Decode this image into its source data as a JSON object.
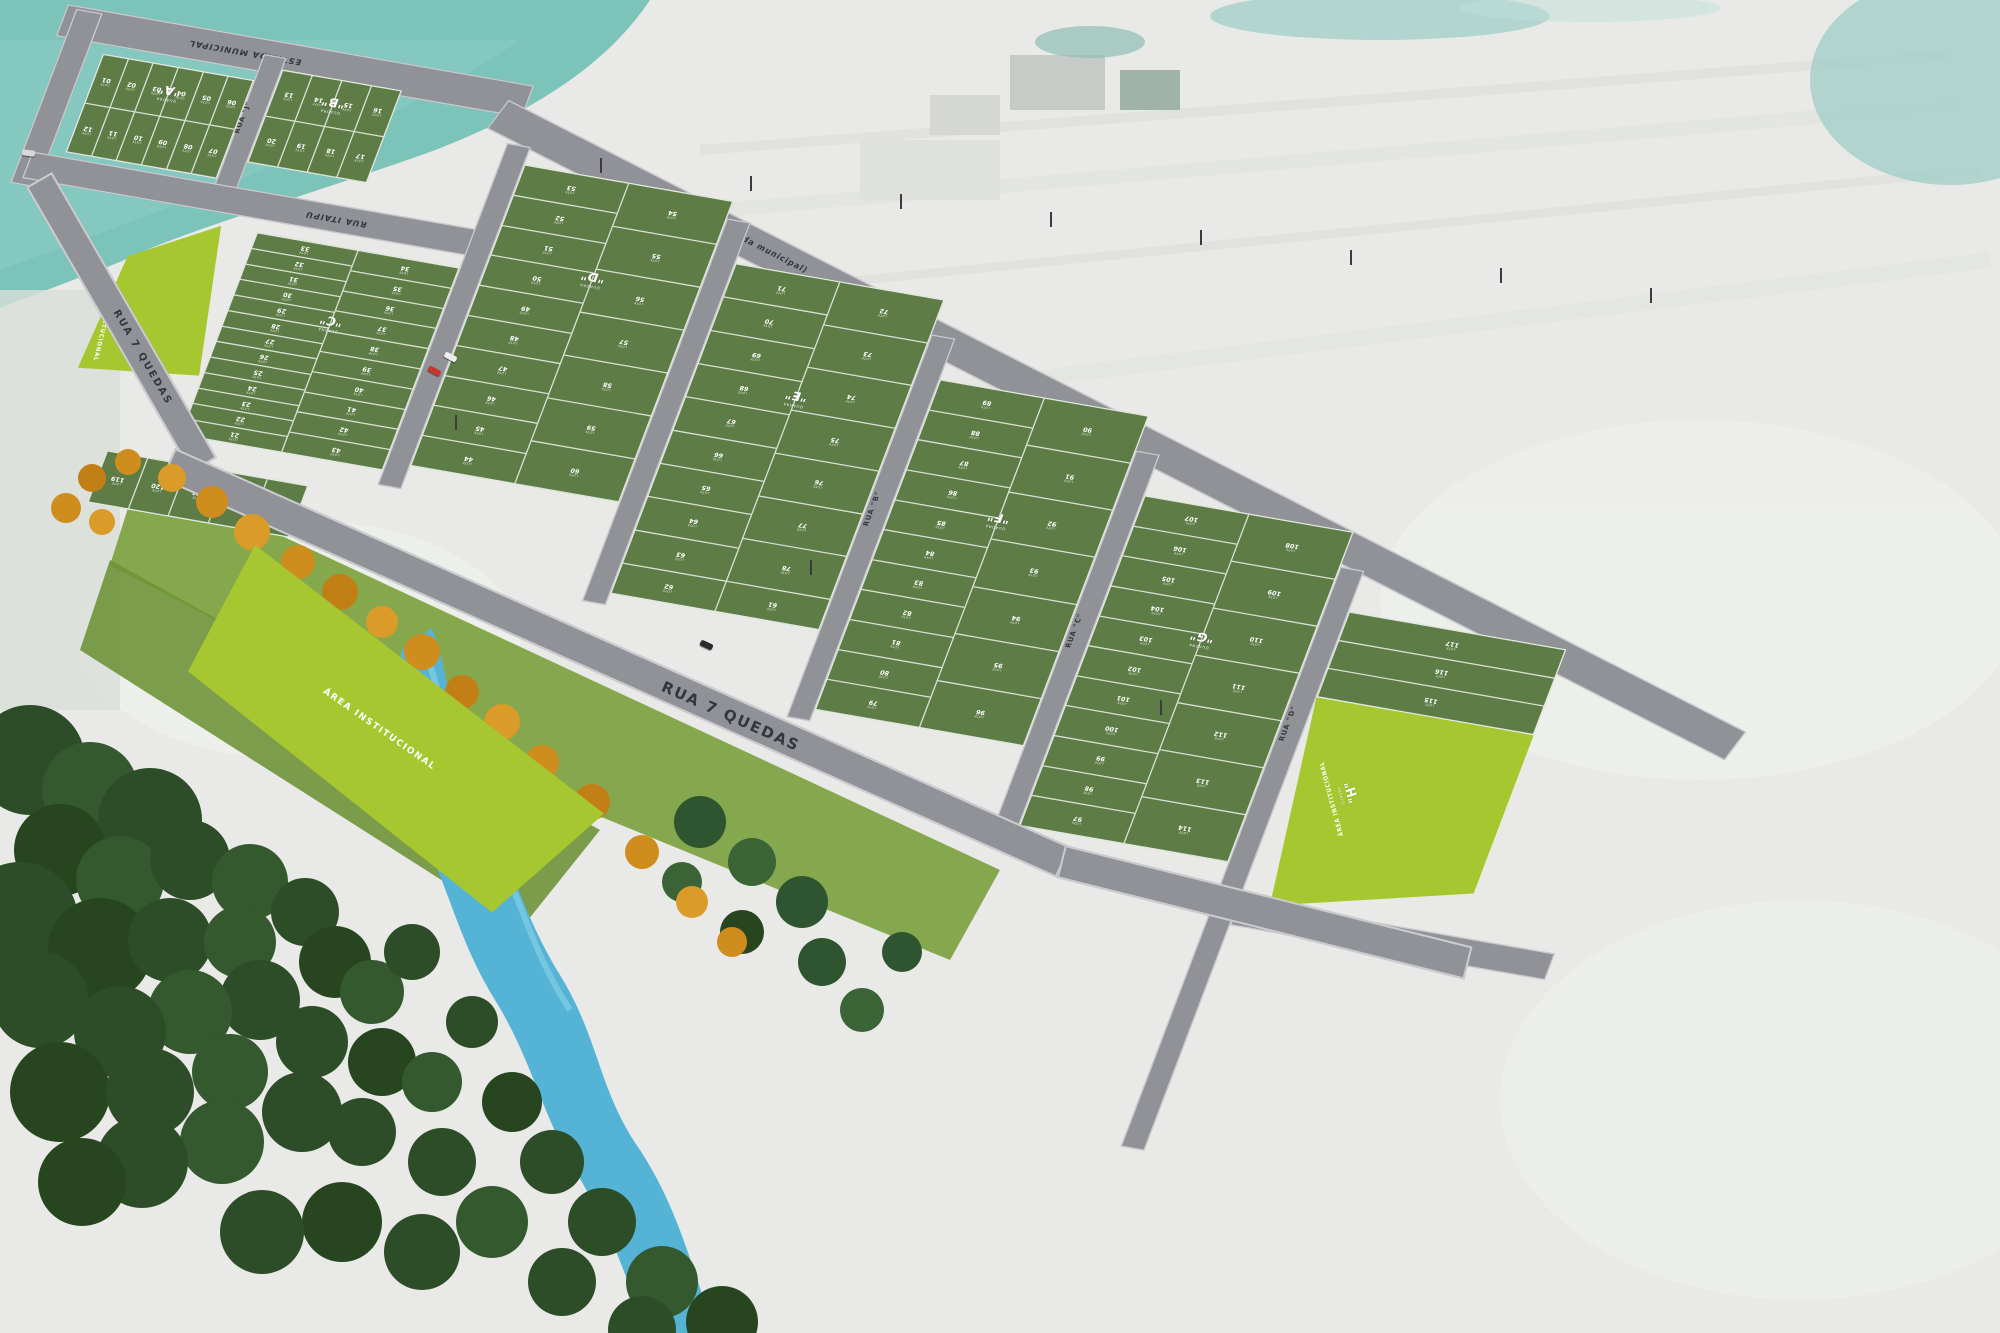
{
  "scene": {
    "quadra_word": "QUADRA",
    "lote_label": "LOTE",
    "streets": {
      "estrada_top": "ESTRADA MUNICIPAL",
      "rua_i": "RUA \"I\" (estrada municipal)",
      "rua_j": "RUA \"J\"",
      "rua_itaipu": "RUA ITAIPU",
      "rua_b": "RUA \"B\"",
      "rua_c": "RUA \"C\"",
      "rua_d": "RUA \"D\"",
      "rua_7quedas_upper": "RUA 7 QUEDAS",
      "rua_7quedas_lower": "RUA 7 QUEDAS"
    },
    "institutional": {
      "left": "ÁREA INSTITUCIONAL",
      "center": "ÁREA INSTITUCIONAL",
      "h": "ÁREA INSTITUCIONAL"
    },
    "blocks": [
      {
        "id": "quadra-a",
        "letter": "\"A\"",
        "type": "rows",
        "rows": [
          [
            "01",
            "02",
            "03",
            "04",
            "05",
            "06"
          ],
          [
            "12",
            "11",
            "10",
            "09",
            "08",
            "07"
          ]
        ]
      },
      {
        "id": "quadra-b",
        "letter": "\"B\"",
        "type": "rows",
        "rows": [
          [
            "13",
            "14",
            "15",
            "16"
          ],
          [
            "20",
            "19",
            "18",
            "17"
          ]
        ]
      },
      {
        "id": "quadra-c",
        "letter": "\"C\"",
        "type": "cols",
        "west": [
          "33",
          "32",
          "31",
          "30",
          "29",
          "28",
          "27",
          "26",
          "25",
          "24",
          "23",
          "22",
          "21"
        ],
        "east": [
          "34",
          "35",
          "36",
          "37",
          "38",
          "39",
          "40",
          "41",
          "42",
          "43"
        ]
      },
      {
        "id": "quadra-d",
        "letter": "\"D\"",
        "type": "cols",
        "west": [
          "53",
          "52",
          "51",
          "50",
          "49",
          "48",
          "47",
          "46",
          "45",
          "44"
        ],
        "east": [
          "54",
          "55",
          "56",
          "57",
          "58",
          "59",
          "60"
        ]
      },
      {
        "id": "quadra-e",
        "letter": "\"E\"",
        "type": "cols",
        "west": [
          "71",
          "70",
          "69",
          "68",
          "67",
          "66",
          "65",
          "64",
          "63"
        ],
        "east": [
          "72",
          "73",
          "74",
          "75",
          "76",
          "77",
          "78"
        ],
        "bottom": [
          "62",
          "61"
        ]
      },
      {
        "id": "quadra-f",
        "letter": "\"F\"",
        "type": "cols",
        "west": [
          "89",
          "88",
          "87",
          "86",
          "85",
          "84",
          "83",
          "82",
          "81",
          "80",
          "79"
        ],
        "east": [
          "90",
          "91",
          "92",
          "93",
          "94",
          "95",
          "96"
        ]
      },
      {
        "id": "quadra-g",
        "letter": "\"G\"",
        "type": "cols",
        "west": [
          "107",
          "106",
          "105",
          "104",
          "103",
          "102",
          "101",
          "100",
          "99",
          "98",
          "97"
        ],
        "east": [
          "108",
          "109",
          "110",
          "111",
          "112",
          "113",
          "114"
        ]
      },
      {
        "id": "quadra-h",
        "letter": "\"H\"",
        "type": "rows",
        "rows": [
          [
            "117"
          ],
          [
            "116"
          ],
          [
            "115"
          ]
        ]
      },
      {
        "id": "block-south",
        "letter": null,
        "type": "rows",
        "rows": [
          [
            "119",
            "120",
            "121",
            "122",
            "123"
          ]
        ]
      }
    ],
    "colors": {
      "lot_green": "#5d7c46",
      "institutional_green": "#a6c72f",
      "road_gray": "#909298",
      "curb": "#cbccd0",
      "water_teal": "#7cc3ba",
      "farmland": "#e9eae7",
      "forest_green": "#2d4d28",
      "river_blue": "#55b4d6",
      "autumn_tree": "#cf8d1e",
      "park_green": "#7aa03c",
      "label_dark": "#35363b",
      "lot_text": "#ffffff"
    },
    "cars": [
      {
        "color": "#c8372d"
      },
      {
        "color": "#ededed"
      },
      {
        "color": "#2a2a2e"
      },
      {
        "color": "#d8d8d8"
      }
    ]
  }
}
